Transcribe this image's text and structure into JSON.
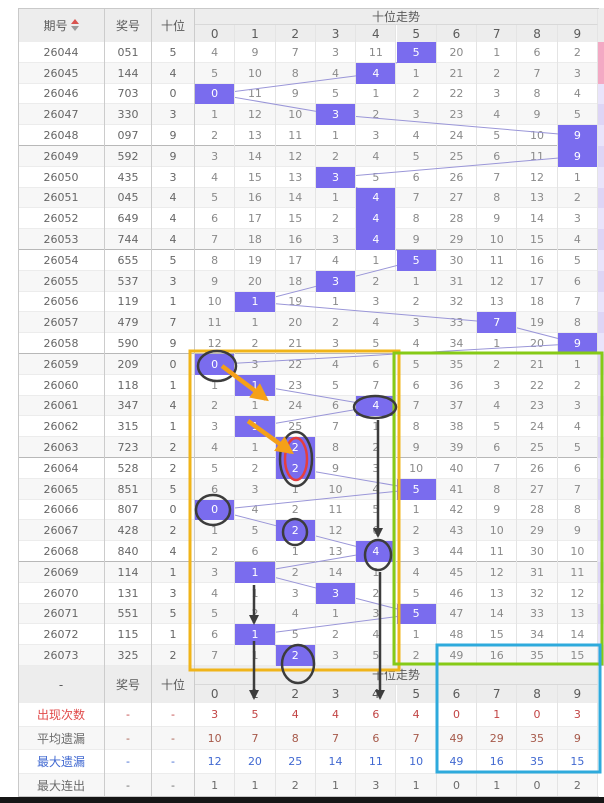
{
  "page": {
    "title": "十位走势"
  },
  "chart_data": {
    "type": "table",
    "title": "十位走势",
    "headers": {
      "period": "期号",
      "prize": "奖号",
      "tens": "十位",
      "trend": "十位走势"
    },
    "digits": [
      "0",
      "1",
      "2",
      "3",
      "4",
      "5",
      "6",
      "7",
      "8",
      "9"
    ],
    "bottom_header": {
      "period": "-",
      "prize": "奖号",
      "tens": "十位",
      "trend": "十位走势"
    },
    "rows": [
      {
        "period": "26044",
        "prize": "051",
        "tens": "5",
        "miss": [
          4,
          9,
          7,
          3,
          11,
          5,
          20,
          1,
          6,
          2
        ]
      },
      {
        "period": "26045",
        "prize": "144",
        "tens": "4",
        "miss": [
          5,
          10,
          8,
          4,
          4,
          1,
          21,
          2,
          7,
          3
        ]
      },
      {
        "period": "26046",
        "prize": "703",
        "tens": "0",
        "miss": [
          0,
          11,
          9,
          5,
          1,
          2,
          22,
          3,
          8,
          4
        ]
      },
      {
        "period": "26047",
        "prize": "330",
        "tens": "3",
        "miss": [
          1,
          12,
          10,
          3,
          2,
          3,
          23,
          4,
          9,
          5
        ]
      },
      {
        "period": "26048",
        "prize": "097",
        "tens": "9",
        "miss": [
          2,
          13,
          11,
          1,
          3,
          4,
          24,
          5,
          10,
          9
        ]
      },
      {
        "period": "26049",
        "prize": "592",
        "tens": "9",
        "miss": [
          3,
          14,
          12,
          2,
          4,
          5,
          25,
          6,
          11,
          9
        ]
      },
      {
        "period": "26050",
        "prize": "435",
        "tens": "3",
        "miss": [
          4,
          15,
          13,
          3,
          5,
          6,
          26,
          7,
          12,
          1
        ]
      },
      {
        "period": "26051",
        "prize": "045",
        "tens": "4",
        "miss": [
          5,
          16,
          14,
          1,
          4,
          7,
          27,
          8,
          13,
          2
        ]
      },
      {
        "period": "26052",
        "prize": "649",
        "tens": "4",
        "miss": [
          6,
          17,
          15,
          2,
          4,
          8,
          28,
          9,
          14,
          3
        ]
      },
      {
        "period": "26053",
        "prize": "744",
        "tens": "4",
        "miss": [
          7,
          18,
          16,
          3,
          4,
          9,
          29,
          10,
          15,
          4
        ]
      },
      {
        "period": "26054",
        "prize": "655",
        "tens": "5",
        "miss": [
          8,
          19,
          17,
          4,
          1,
          5,
          30,
          11,
          16,
          5
        ]
      },
      {
        "period": "26055",
        "prize": "537",
        "tens": "3",
        "miss": [
          9,
          20,
          18,
          3,
          2,
          1,
          31,
          12,
          17,
          6
        ]
      },
      {
        "period": "26056",
        "prize": "119",
        "tens": "1",
        "miss": [
          10,
          1,
          19,
          1,
          3,
          2,
          32,
          13,
          18,
          7
        ]
      },
      {
        "period": "26057",
        "prize": "479",
        "tens": "7",
        "miss": [
          11,
          1,
          20,
          2,
          4,
          3,
          33,
          7,
          19,
          8
        ]
      },
      {
        "period": "26058",
        "prize": "590",
        "tens": "9",
        "miss": [
          12,
          2,
          21,
          3,
          5,
          4,
          34,
          1,
          20,
          9
        ]
      },
      {
        "period": "26059",
        "prize": "209",
        "tens": "0",
        "miss": [
          0,
          3,
          22,
          4,
          6,
          5,
          35,
          2,
          21,
          1
        ]
      },
      {
        "period": "26060",
        "prize": "118",
        "tens": "1",
        "miss": [
          1,
          1,
          23,
          5,
          7,
          6,
          36,
          3,
          22,
          2
        ]
      },
      {
        "period": "26061",
        "prize": "347",
        "tens": "4",
        "miss": [
          2,
          1,
          24,
          6,
          4,
          7,
          37,
          4,
          23,
          3
        ]
      },
      {
        "period": "26062",
        "prize": "315",
        "tens": "1",
        "miss": [
          3,
          1,
          25,
          7,
          1,
          8,
          38,
          5,
          24,
          4
        ]
      },
      {
        "period": "26063",
        "prize": "723",
        "tens": "2",
        "miss": [
          4,
          1,
          2,
          8,
          2,
          9,
          39,
          6,
          25,
          5
        ]
      },
      {
        "period": "26064",
        "prize": "528",
        "tens": "2",
        "miss": [
          5,
          2,
          2,
          9,
          3,
          10,
          40,
          7,
          26,
          6
        ]
      },
      {
        "period": "26065",
        "prize": "851",
        "tens": "5",
        "miss": [
          6,
          3,
          1,
          10,
          4,
          5,
          41,
          8,
          27,
          7
        ]
      },
      {
        "period": "26066",
        "prize": "807",
        "tens": "0",
        "miss": [
          0,
          4,
          2,
          11,
          5,
          1,
          42,
          9,
          28,
          8
        ]
      },
      {
        "period": "26067",
        "prize": "428",
        "tens": "2",
        "miss": [
          1,
          5,
          2,
          12,
          6,
          2,
          43,
          10,
          29,
          9
        ]
      },
      {
        "period": "26068",
        "prize": "840",
        "tens": "4",
        "miss": [
          2,
          6,
          1,
          13,
          4,
          3,
          44,
          11,
          30,
          10
        ]
      },
      {
        "period": "26069",
        "prize": "114",
        "tens": "1",
        "miss": [
          3,
          1,
          2,
          14,
          1,
          4,
          45,
          12,
          31,
          11
        ]
      },
      {
        "period": "26070",
        "prize": "131",
        "tens": "3",
        "miss": [
          4,
          1,
          3,
          3,
          2,
          5,
          46,
          13,
          32,
          12
        ]
      },
      {
        "period": "26071",
        "prize": "551",
        "tens": "5",
        "miss": [
          5,
          2,
          4,
          1,
          3,
          5,
          47,
          14,
          33,
          13
        ]
      },
      {
        "period": "26072",
        "prize": "115",
        "tens": "1",
        "miss": [
          6,
          1,
          5,
          2,
          4,
          1,
          48,
          15,
          34,
          14
        ]
      },
      {
        "period": "26073",
        "prize": "325",
        "tens": "2",
        "miss": [
          7,
          1,
          2,
          3,
          5,
          2,
          49,
          16,
          35,
          15
        ]
      }
    ],
    "summary": [
      {
        "label": "出现次数",
        "dash": "-",
        "values": [
          3,
          5,
          4,
          4,
          6,
          4,
          0,
          1,
          0,
          3
        ],
        "label_color": "#e14b4b",
        "value_color": "#c24444"
      },
      {
        "label": "平均遗漏",
        "dash": "-",
        "values": [
          10,
          7,
          8,
          7,
          6,
          7,
          49,
          29,
          35,
          9
        ],
        "label_color": "#6b6b6b",
        "value_color": "#a6594a"
      },
      {
        "label": "最大遗漏",
        "dash": "-",
        "values": [
          12,
          20,
          25,
          14,
          11,
          10,
          49,
          16,
          35,
          15
        ],
        "label_color": "#4169d1",
        "value_color": "#4169d1"
      },
      {
        "label": "最大连出",
        "dash": "-",
        "values": [
          1,
          1,
          2,
          1,
          3,
          1,
          0,
          1,
          0,
          2
        ],
        "label_color": "#6b6b6b",
        "value_color": "#6b6b6b"
      }
    ]
  },
  "colors": {
    "hit_bg": "#7a6cee",
    "connector": "#9a96d8",
    "yellow_rect": "#f0b419",
    "green_rect": "#86ca16",
    "blue_rect": "#2eaadc",
    "orange_arrow": "#f5a018",
    "black_ink": "#3c3c3c",
    "red_circle": "#e53e3e",
    "header_bg": "#ededed",
    "stripe": "#f7f7f7",
    "sort_up": "#d9534f",
    "sort_down": "#9a9a9a"
  },
  "annotations": {
    "rects": [
      {
        "name": "yellow-highlight-rect",
        "x": 190,
        "y": 351,
        "w": 209,
        "h": 319,
        "colorKey": "yellow_rect"
      },
      {
        "name": "green-highlight-rect",
        "x": 394,
        "y": 353,
        "w": 208,
        "h": 311,
        "colorKey": "green_rect"
      },
      {
        "name": "blue-highlight-rect",
        "x": 437,
        "y": 645,
        "w": 163,
        "h": 127,
        "colorKey": "blue_rect"
      }
    ],
    "ellipses": [
      {
        "name": "circle-0-26059",
        "cx": 217,
        "cy": 366,
        "rx": 19,
        "ry": 15,
        "colorKey": "black_ink"
      },
      {
        "name": "circle-4-26061",
        "cx": 375,
        "cy": 407,
        "rx": 21,
        "ry": 11,
        "colorKey": "black_ink"
      },
      {
        "name": "circle-2-26063-outer",
        "cx": 296,
        "cy": 459,
        "rx": 16,
        "ry": 27,
        "colorKey": "black_ink"
      },
      {
        "name": "circle-2-26063-inner-red",
        "cx": 296,
        "cy": 459,
        "rx": 11,
        "ry": 21,
        "colorKey": "red_circle"
      },
      {
        "name": "circle-0-26066",
        "cx": 213,
        "cy": 510,
        "rx": 17,
        "ry": 15,
        "colorKey": "black_ink"
      },
      {
        "name": "circle-2-26067",
        "cx": 295,
        "cy": 532,
        "rx": 12,
        "ry": 13,
        "colorKey": "black_ink"
      },
      {
        "name": "circle-4-26068",
        "cx": 378,
        "cy": 555,
        "rx": 13,
        "ry": 15,
        "colorKey": "black_ink"
      },
      {
        "name": "circle-2-26073",
        "cx": 298,
        "cy": 664,
        "rx": 16,
        "ry": 19,
        "colorKey": "black_ink"
      }
    ],
    "arrows": [
      {
        "name": "orange-arrow-1",
        "x1": 222,
        "y1": 366,
        "x2": 266,
        "y2": 399,
        "colorKey": "orange_arrow",
        "w": 4.5
      },
      {
        "name": "orange-arrow-2",
        "x1": 248,
        "y1": 421,
        "x2": 291,
        "y2": 452,
        "colorKey": "orange_arrow",
        "w": 4.5
      },
      {
        "name": "black-arrow-col4-upper",
        "x1": 378,
        "y1": 420,
        "x2": 378,
        "y2": 536,
        "colorKey": "black_ink",
        "w": 2.5
      },
      {
        "name": "black-arrow-col4-lower",
        "x1": 380,
        "y1": 572,
        "x2": 380,
        "y2": 698,
        "colorKey": "black_ink",
        "w": 2.5
      },
      {
        "name": "black-arrow-col1-upper",
        "x1": 254,
        "y1": 585,
        "x2": 254,
        "y2": 623,
        "colorKey": "black_ink",
        "w": 2.5
      },
      {
        "name": "black-arrow-col1-lower",
        "x1": 254,
        "y1": 641,
        "x2": 254,
        "y2": 698,
        "colorKey": "black_ink",
        "w": 2.5
      }
    ]
  }
}
